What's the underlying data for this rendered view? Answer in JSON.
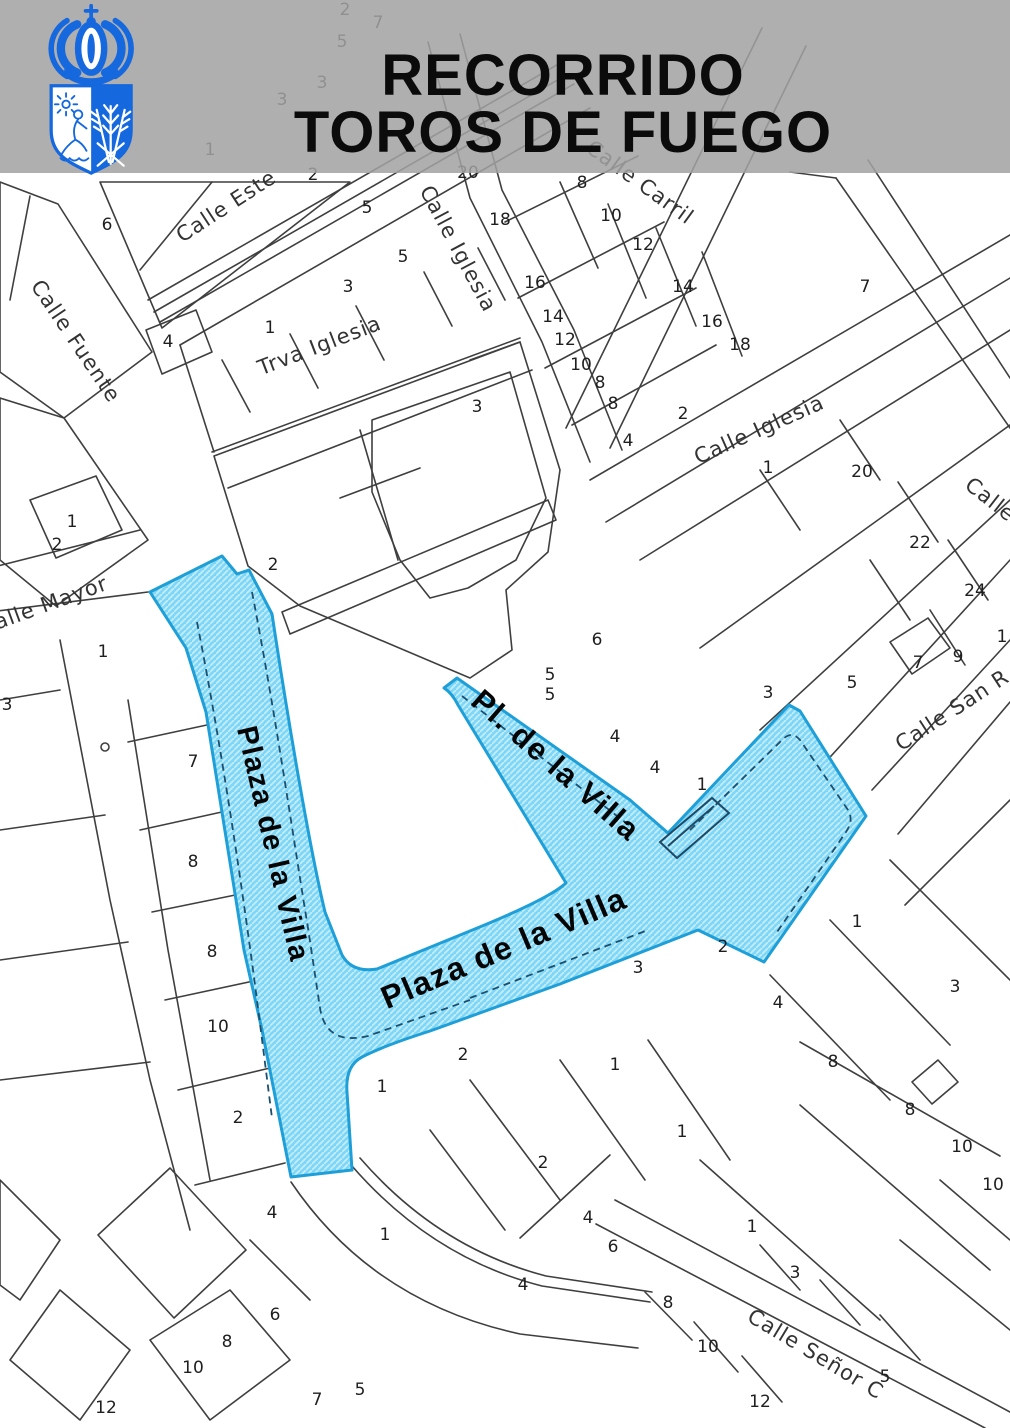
{
  "header": {
    "title_line1": "RECORRIDO",
    "title_line2": "TOROS DE FUEGO",
    "crest": "municipal-coat-of-arms",
    "band_color": "rgba(162,162,162,0.86)",
    "crest_color": "#1568DE"
  },
  "map": {
    "route": {
      "name": "Toros de Fuego route highlight",
      "fill_color": "#7FD6F5",
      "hatch_color": "#C2EDFB",
      "border_color": "#1E9FD8",
      "labels": [
        {
          "text": "Plaza de la Villa",
          "x": 264,
          "y": 846,
          "rot": 77,
          "size": 29
        },
        {
          "text": "Pl. de la Villa",
          "x": 549,
          "y": 773,
          "rot": 41,
          "size": 31
        },
        {
          "text": "Plaza de la Villa",
          "x": 508,
          "y": 958,
          "rot": -23,
          "size": 32
        }
      ]
    },
    "street_labels": [
      {
        "text": "Calle Este",
        "x": 230,
        "y": 212,
        "rot": -33
      },
      {
        "text": "Calle Fuente",
        "x": 70,
        "y": 345,
        "rot": 56
      },
      {
        "text": "Calle Iglesia",
        "x": 452,
        "y": 252,
        "rot": 62
      },
      {
        "text": "Trva Iglesia",
        "x": 322,
        "y": 352,
        "rot": -21
      },
      {
        "text": "Calle Carril",
        "x": 636,
        "y": 188,
        "rot": 36
      },
      {
        "text": "Calle Iglesia",
        "x": 762,
        "y": 436,
        "rot": -24
      },
      {
        "text": "Calle Mayor",
        "x": 46,
        "y": 612,
        "rot": -20
      },
      {
        "text": "Calle",
        "x": 986,
        "y": 505,
        "rot": 38
      },
      {
        "text": "Calle San R",
        "x": 956,
        "y": 716,
        "rot": -33
      },
      {
        "text": "Calle Señor C",
        "x": 812,
        "y": 1360,
        "rot": 31
      }
    ],
    "parcel_numbers": [
      {
        "n": "2",
        "x": 345,
        "y": 15
      },
      {
        "n": "7",
        "x": 378,
        "y": 28
      },
      {
        "n": "5",
        "x": 342,
        "y": 47
      },
      {
        "n": "3",
        "x": 322,
        "y": 88
      },
      {
        "n": "3",
        "x": 282,
        "y": 105
      },
      {
        "n": "1",
        "x": 210,
        "y": 155
      },
      {
        "n": "6",
        "x": 107,
        "y": 230
      },
      {
        "n": "4",
        "x": 168,
        "y": 347
      },
      {
        "n": "1",
        "x": 270,
        "y": 333
      },
      {
        "n": "3",
        "x": 348,
        "y": 292
      },
      {
        "n": "5",
        "x": 367,
        "y": 213
      },
      {
        "n": "5",
        "x": 403,
        "y": 262
      },
      {
        "n": "2",
        "x": 313,
        "y": 180
      },
      {
        "n": "20",
        "x": 468,
        "y": 178
      },
      {
        "n": "3",
        "x": 477,
        "y": 412
      },
      {
        "n": "18",
        "x": 500,
        "y": 225
      },
      {
        "n": "16",
        "x": 535,
        "y": 288
      },
      {
        "n": "14",
        "x": 553,
        "y": 322
      },
      {
        "n": "12",
        "x": 565,
        "y": 345
      },
      {
        "n": "10",
        "x": 581,
        "y": 370
      },
      {
        "n": "8",
        "x": 600,
        "y": 388
      },
      {
        "n": "8",
        "x": 613,
        "y": 409
      },
      {
        "n": "4",
        "x": 628,
        "y": 446
      },
      {
        "n": "2",
        "x": 683,
        "y": 419
      },
      {
        "n": "8",
        "x": 582,
        "y": 188
      },
      {
        "n": "10",
        "x": 611,
        "y": 221
      },
      {
        "n": "12",
        "x": 643,
        "y": 250
      },
      {
        "n": "14",
        "x": 683,
        "y": 292
      },
      {
        "n": "16",
        "x": 712,
        "y": 327
      },
      {
        "n": "18",
        "x": 740,
        "y": 350
      },
      {
        "n": "7",
        "x": 865,
        "y": 292
      },
      {
        "n": "1",
        "x": 72,
        "y": 527
      },
      {
        "n": "2",
        "x": 57,
        "y": 550
      },
      {
        "n": "2",
        "x": 273,
        "y": 570
      },
      {
        "n": "1",
        "x": 103,
        "y": 657
      },
      {
        "n": "3",
        "x": 7,
        "y": 710
      },
      {
        "n": "7",
        "x": 193,
        "y": 767
      },
      {
        "n": "8",
        "x": 193,
        "y": 867
      },
      {
        "n": "8",
        "x": 212,
        "y": 957
      },
      {
        "n": "10",
        "x": 218,
        "y": 1032
      },
      {
        "n": "1",
        "x": 768,
        "y": 473
      },
      {
        "n": "20",
        "x": 862,
        "y": 477
      },
      {
        "n": "22",
        "x": 920,
        "y": 548
      },
      {
        "n": "24",
        "x": 975,
        "y": 596
      },
      {
        "n": "7",
        "x": 918,
        "y": 668
      },
      {
        "n": "9",
        "x": 958,
        "y": 662
      },
      {
        "n": "5",
        "x": 852,
        "y": 688
      },
      {
        "n": "1",
        "x": 1002,
        "y": 642
      },
      {
        "n": "6",
        "x": 597,
        "y": 645
      },
      {
        "n": "5",
        "x": 550,
        "y": 680
      },
      {
        "n": "5",
        "x": 550,
        "y": 700
      },
      {
        "n": "4",
        "x": 615,
        "y": 742
      },
      {
        "n": "4",
        "x": 655,
        "y": 773
      },
      {
        "n": "1",
        "x": 702,
        "y": 790
      },
      {
        "n": "3",
        "x": 768,
        "y": 698
      },
      {
        "n": "2",
        "x": 723,
        "y": 952
      },
      {
        "n": "3",
        "x": 638,
        "y": 973
      },
      {
        "n": "3",
        "x": 955,
        "y": 992
      },
      {
        "n": "1",
        "x": 857,
        "y": 927
      },
      {
        "n": "2",
        "x": 463,
        "y": 1060
      },
      {
        "n": "1",
        "x": 382,
        "y": 1092
      },
      {
        "n": "1",
        "x": 385,
        "y": 1240
      },
      {
        "n": "2",
        "x": 238,
        "y": 1123
      },
      {
        "n": "4",
        "x": 272,
        "y": 1218
      },
      {
        "n": "6",
        "x": 275,
        "y": 1320
      },
      {
        "n": "8",
        "x": 227,
        "y": 1347
      },
      {
        "n": "10",
        "x": 193,
        "y": 1373
      },
      {
        "n": "12",
        "x": 106,
        "y": 1413
      },
      {
        "n": "7",
        "x": 317,
        "y": 1405
      },
      {
        "n": "5",
        "x": 360,
        "y": 1395
      },
      {
        "n": "2",
        "x": 543,
        "y": 1168
      },
      {
        "n": "1",
        "x": 615,
        "y": 1070
      },
      {
        "n": "1",
        "x": 682,
        "y": 1137
      },
      {
        "n": "4",
        "x": 588,
        "y": 1223
      },
      {
        "n": "6",
        "x": 613,
        "y": 1252
      },
      {
        "n": "4",
        "x": 523,
        "y": 1290
      },
      {
        "n": "8",
        "x": 668,
        "y": 1308
      },
      {
        "n": "10",
        "x": 708,
        "y": 1352
      },
      {
        "n": "12",
        "x": 760,
        "y": 1407
      },
      {
        "n": "1",
        "x": 752,
        "y": 1232
      },
      {
        "n": "3",
        "x": 795,
        "y": 1278
      },
      {
        "n": "4",
        "x": 778,
        "y": 1008
      },
      {
        "n": "8",
        "x": 833,
        "y": 1067
      },
      {
        "n": "8",
        "x": 910,
        "y": 1115
      },
      {
        "n": "10",
        "x": 962,
        "y": 1152
      },
      {
        "n": "10",
        "x": 993,
        "y": 1190
      },
      {
        "n": "5",
        "x": 885,
        "y": 1382
      }
    ]
  }
}
